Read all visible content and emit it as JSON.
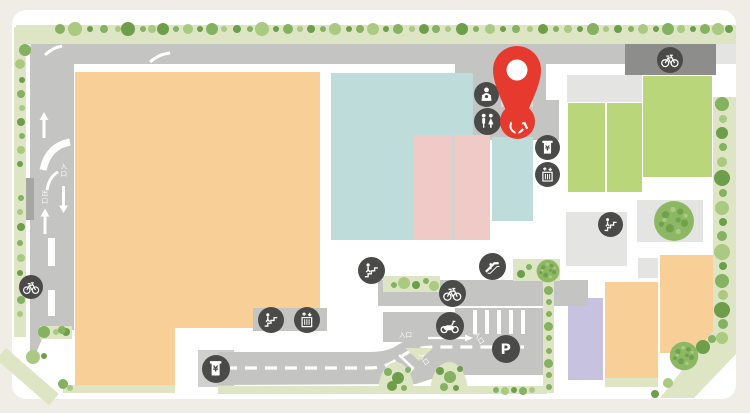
{
  "map": {
    "kind": "facility-map",
    "colors": {
      "background": "#f0ece6",
      "card": "#ffffff",
      "road": "#c4c4c2",
      "road_dark": "#8d8d8b",
      "building_gray": "#e4e4e2",
      "building_orange": "#f8d097",
      "building_teal": "#bedcd9",
      "building_pink": "#f0cac7",
      "building_green": "#b9d77a",
      "building_purple": "#c7c2e0",
      "greenery": "#dde5c4",
      "tree_greens": [
        "#84b261",
        "#a9ca80",
        "#6d9e4a"
      ],
      "marker_bg": "#4a4a48",
      "accent_red": "#e63a2e"
    },
    "pin": {
      "name": "destination-pin",
      "x": 517,
      "y": 137
    },
    "markers": [
      {
        "type": "bicycle",
        "x": 670,
        "y": 60,
        "r": 13
      },
      {
        "type": "baby-care",
        "x": 486,
        "y": 94,
        "r": 12.5
      },
      {
        "type": "restroom",
        "x": 487,
        "y": 121,
        "r": 13.5
      },
      {
        "type": "wheelchair",
        "x": 517,
        "y": 121,
        "r": 17.5,
        "color": "#e63a2e"
      },
      {
        "type": "atm",
        "x": 547,
        "y": 147,
        "r": 12.5
      },
      {
        "type": "elevator",
        "x": 547,
        "y": 174,
        "r": 12.5
      },
      {
        "type": "stairs",
        "x": 610,
        "y": 224,
        "r": 12.5
      },
      {
        "type": "stairs",
        "x": 371,
        "y": 270,
        "r": 13.5
      },
      {
        "type": "escalator",
        "x": 492,
        "y": 266,
        "r": 13.5
      },
      {
        "type": "bicycle",
        "x": 452,
        "y": 293,
        "r": 13.5
      },
      {
        "type": "motorcycle",
        "x": 450,
        "y": 326,
        "r": 14
      },
      {
        "type": "parking",
        "x": 506,
        "y": 349,
        "r": 14,
        "label": "P"
      },
      {
        "type": "atm",
        "x": 216,
        "y": 369,
        "r": 14
      },
      {
        "type": "stairs",
        "x": 271,
        "y": 320,
        "r": 13
      },
      {
        "type": "elevator",
        "x": 307,
        "y": 320,
        "r": 13
      },
      {
        "type": "bicycle",
        "x": 31,
        "y": 287,
        "r": 12
      }
    ],
    "road_labels": [
      {
        "text": "入口",
        "x": 59,
        "y": 163,
        "vertical": true
      },
      {
        "text": "出口",
        "x": 40,
        "y": 190,
        "vertical": true
      },
      {
        "text": "入口",
        "x": 399,
        "y": 332,
        "vertical": false,
        "rot": 0
      },
      {
        "text": "入口",
        "x": 417,
        "y": 356,
        "vertical": false,
        "rot": 58
      },
      {
        "text": "入口",
        "x": 472,
        "y": 335,
        "vertical": false,
        "rot": 58
      }
    ]
  }
}
